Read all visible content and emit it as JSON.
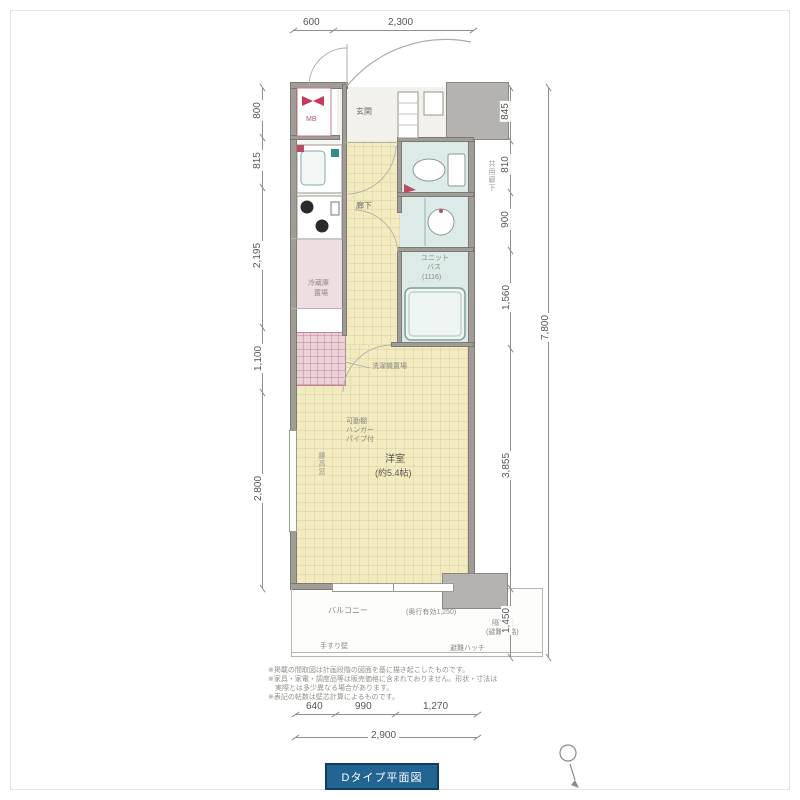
{
  "floorplan": {
    "type_label": "Dタイプ平面図",
    "rooms": {
      "entrance": "玄関",
      "hallway": "廊下",
      "western_room": "洋室",
      "western_room_size": "(約5.4帖)",
      "unit_bath_line1": "ユニット",
      "unit_bath_line2": "バス",
      "unit_bath_size": "(1116)",
      "balcony": "バルコニー",
      "refrigerator_line1": "冷蔵庫",
      "refrigerator_line2": "置場",
      "meter_box": "MB"
    },
    "annotations": {
      "washer": "洗濯機置場",
      "closet_line1": "可動棚",
      "closet_line2": "ハンガー",
      "closet_line3": "パイプ付",
      "window": "腰高窓",
      "corridor": "共用廊下",
      "balcony_depth": "(奥行有効1,250)",
      "handrail": "手すり壁",
      "hatch": "避難ハッチ",
      "partition_line1": "隔て板",
      "partition_line2": "(避難経路)"
    },
    "dimensions": {
      "top": [
        "600",
        "2,300"
      ],
      "left": [
        "800",
        "815",
        "2,195",
        "1,100",
        "2,800"
      ],
      "right": [
        "845",
        "810",
        "900",
        "1,560",
        "3,855",
        "1,450"
      ],
      "right_total": "7,800",
      "bottom": [
        "640",
        "990",
        "1,270"
      ],
      "bottom_total": "2,900"
    },
    "notes": [
      "※掲載の間取図は計画段階の図面を基に描き起こしたものです。",
      "※家具・家電・調度品等は販売価格に含まれておりません。形状・寸法は",
      "　実際とは多少異なる場合があります。",
      "※表記の帖数は壁芯計算によるものです。"
    ]
  },
  "colors": {
    "accent_blue": "#226593",
    "floor_yellow": "#f1ebbf",
    "wet_area_teal": "#dcebe8",
    "pink_area": "#ead3d8",
    "wall_gray": "#a09c96"
  }
}
